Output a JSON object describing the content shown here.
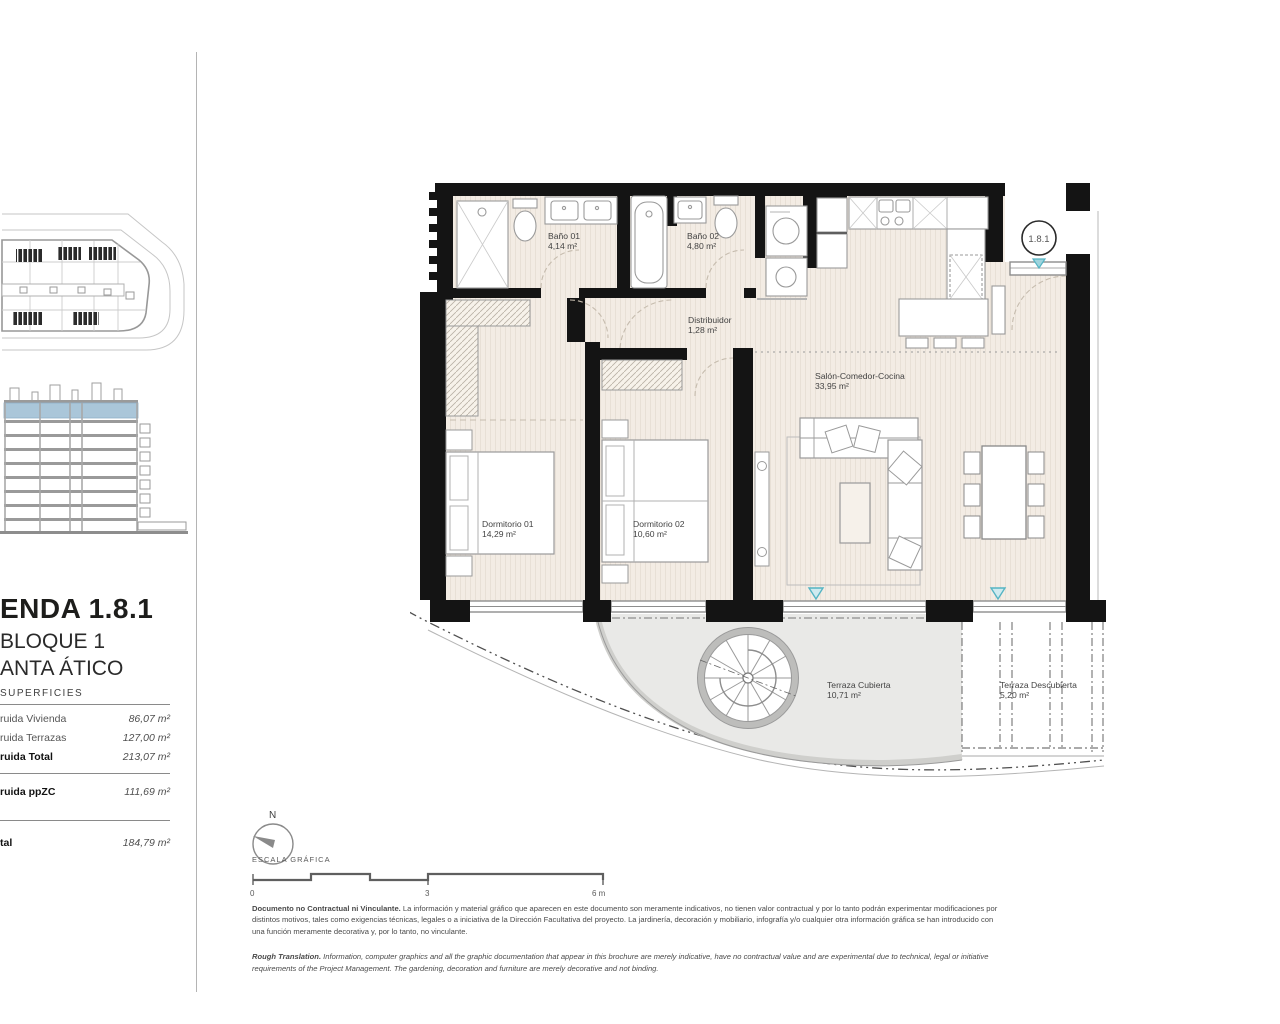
{
  "sidebar": {
    "title": "ENDA 1.8.1",
    "block": "BLOQUE 1",
    "floor": "ANTA ÁTICO",
    "superficies": {
      "heading": "SUPERFICIES",
      "rows": [
        {
          "label": "ruida Vivienda",
          "value": "86,07 m²"
        },
        {
          "label": "ruida Terrazas",
          "value": "127,00 m²"
        },
        {
          "label": "ruida Total",
          "value": "213,07 m²"
        },
        {
          "label": "ruida ppZC",
          "value": "111,69 m²"
        },
        {
          "label": "tal",
          "value": "184,79 m²"
        }
      ]
    }
  },
  "plan": {
    "unit_badge": "1.8.1",
    "rooms": [
      {
        "name": "Baño 01",
        "area": "4,14 m²"
      },
      {
        "name": "Baño 02",
        "area": "4,80 m²"
      },
      {
        "name": "Distribuidor",
        "area": "1,28 m²"
      },
      {
        "name": "Salón-Comedor-Cocina",
        "area": "33,95 m²"
      },
      {
        "name": "Dormitorio 01",
        "area": "14,29 m²"
      },
      {
        "name": "Dormitorio 02",
        "area": "10,60 m²"
      },
      {
        "name": "Terraza Cubierta",
        "area": "10,71 m²"
      },
      {
        "name": "Terraza Descubierta",
        "area": "5,20 m²"
      }
    ]
  },
  "compass": {
    "north_label": "N"
  },
  "scale_bar": {
    "label": "ESCALA GRÁFICA",
    "ticks": [
      "0",
      "3",
      "6 m"
    ]
  },
  "legal": {
    "es_lead": "Documento no Contractual ni Vinculante.",
    "es_body": " La información y material gráfico que aparecen en este documento son meramente indicativos, no tienen valor contractual y por lo tanto podrán experimentar modificaciones por distintos motivos, tales como exigencias técnicas, legales o a iniciativa de la Dirección Facultativa del proyecto. La jardinería, decoración y mobiliario, infografía y/o cualquier otra información gráfica se han introducido con una función meramente decorativa y, por lo tanto, no vinculante.",
    "en_lead": "Rough Translation.",
    "en_body": " Information, computer graphics and all the graphic documentation that appear in this brochure are merely indicative, have no contractual value and are experimental due to technical, legal or initiative requirements of the Project Management. The gardening, decoration and furniture are merely decorative and not binding."
  },
  "colors": {
    "accent_teal": "#54b4c4",
    "elevation_highlight": "#aac6d9",
    "wall": "#141414",
    "floor": "#f3ece4",
    "terrace": "#e9e9e7"
  }
}
